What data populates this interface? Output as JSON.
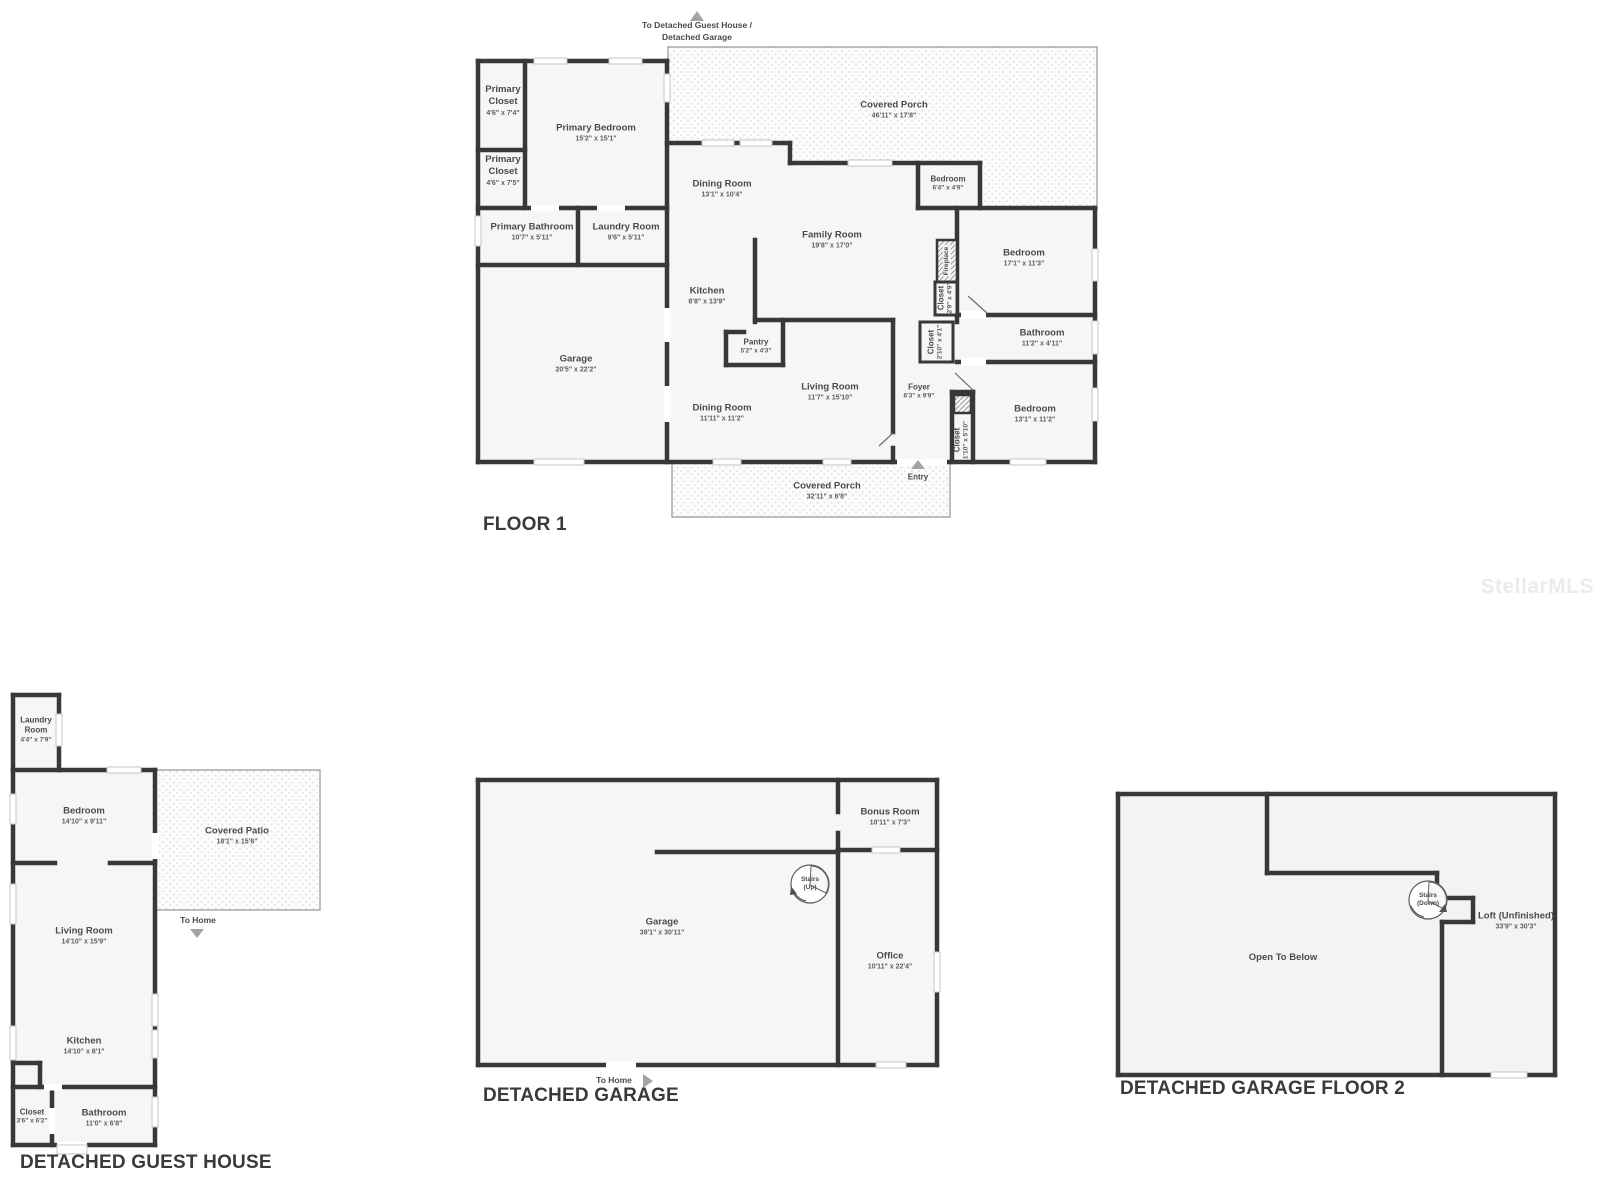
{
  "watermark": "StellarMLS",
  "floor1": {
    "title": "FLOOR 1",
    "direction_label": "To Detached Guest House /\nDetached Garage",
    "entry_label": "Entry",
    "rooms": [
      {
        "name": "Primary Closet",
        "dims": "4'6\" x 7'4\""
      },
      {
        "name": "Primary Bedroom",
        "dims": "15'2\" x 15'1\""
      },
      {
        "name": "Primary Closet",
        "dims": "4'6\" x 7'5\""
      },
      {
        "name": "Primary Bathroom",
        "dims": "10'7\" x 5'11\""
      },
      {
        "name": "Laundry Room",
        "dims": "9'6\" x 5'11\""
      },
      {
        "name": "Garage",
        "dims": "20'5\" x 22'2\""
      },
      {
        "name": "Covered Porch",
        "dims": "46'11\" x 17'8\""
      },
      {
        "name": "Dining Room",
        "dims": "13'1\" x 10'4\""
      },
      {
        "name": "Family Room",
        "dims": "19'8\" x 17'0\""
      },
      {
        "name": "Kitchen",
        "dims": "8'8\" x 13'9\""
      },
      {
        "name": "Pantry",
        "dims": "5'2\" x 4'3\""
      },
      {
        "name": "Bedroom",
        "dims": "6'4\" x 4'9\""
      },
      {
        "name": "Bedroom",
        "dims": "17'1\" x 11'3\""
      },
      {
        "name": "Fireplace",
        "dims": ""
      },
      {
        "name": "Closet",
        "dims": "2'9\" x 4'9\""
      },
      {
        "name": "Closet",
        "dims": "2'10\" x 4'1\""
      },
      {
        "name": "Bathroom",
        "dims": "11'2\" x 4'11\""
      },
      {
        "name": "Living Room",
        "dims": "11'7\" x 15'10\""
      },
      {
        "name": "Dining Room",
        "dims": "11'11\" x 11'2\""
      },
      {
        "name": "Foyer",
        "dims": "6'3\" x 9'9\""
      },
      {
        "name": "Closet",
        "dims": "1'10\" x 5'10\""
      },
      {
        "name": "Bedroom",
        "dims": "13'1\" x 11'2\""
      },
      {
        "name": "Covered Porch",
        "dims": "32'11\" x 6'8\""
      }
    ]
  },
  "guest_house": {
    "title": "DETACHED GUEST HOUSE",
    "direction_label": "To Home",
    "rooms": [
      {
        "name": "Laundry Room",
        "dims": "4'4\" x 7'9\""
      },
      {
        "name": "Bedroom",
        "dims": "14'10\" x 9'11\""
      },
      {
        "name": "Covered Patio",
        "dims": "18'1\" x 15'6\""
      },
      {
        "name": "Living Room",
        "dims": "14'10\" x 15'9\""
      },
      {
        "name": "Kitchen",
        "dims": "14'10\" x 8'1\""
      },
      {
        "name": "Closet",
        "dims": "3'6\" x 6'2\""
      },
      {
        "name": "Bathroom",
        "dims": "11'0\" x 6'8\""
      }
    ]
  },
  "detached_garage": {
    "title": "DETACHED GARAGE",
    "direction_label": "To Home",
    "stairs_label": "Stairs\n(Up)",
    "rooms": [
      {
        "name": "Garage",
        "dims": "39'1\" x 30'11\""
      },
      {
        "name": "Bonus Room",
        "dims": "10'11\" x 7'3\""
      },
      {
        "name": "Office",
        "dims": "10'11\" x 22'4\""
      }
    ]
  },
  "detached_garage_floor2": {
    "title": "DETACHED GARAGE FLOOR 2",
    "stairs_label": "Stairs\n(Down)",
    "rooms": [
      {
        "name": "Open To Below",
        "dims": ""
      },
      {
        "name": "Loft (Unfinished)",
        "dims": "33'9\" x 30'3\""
      }
    ]
  }
}
